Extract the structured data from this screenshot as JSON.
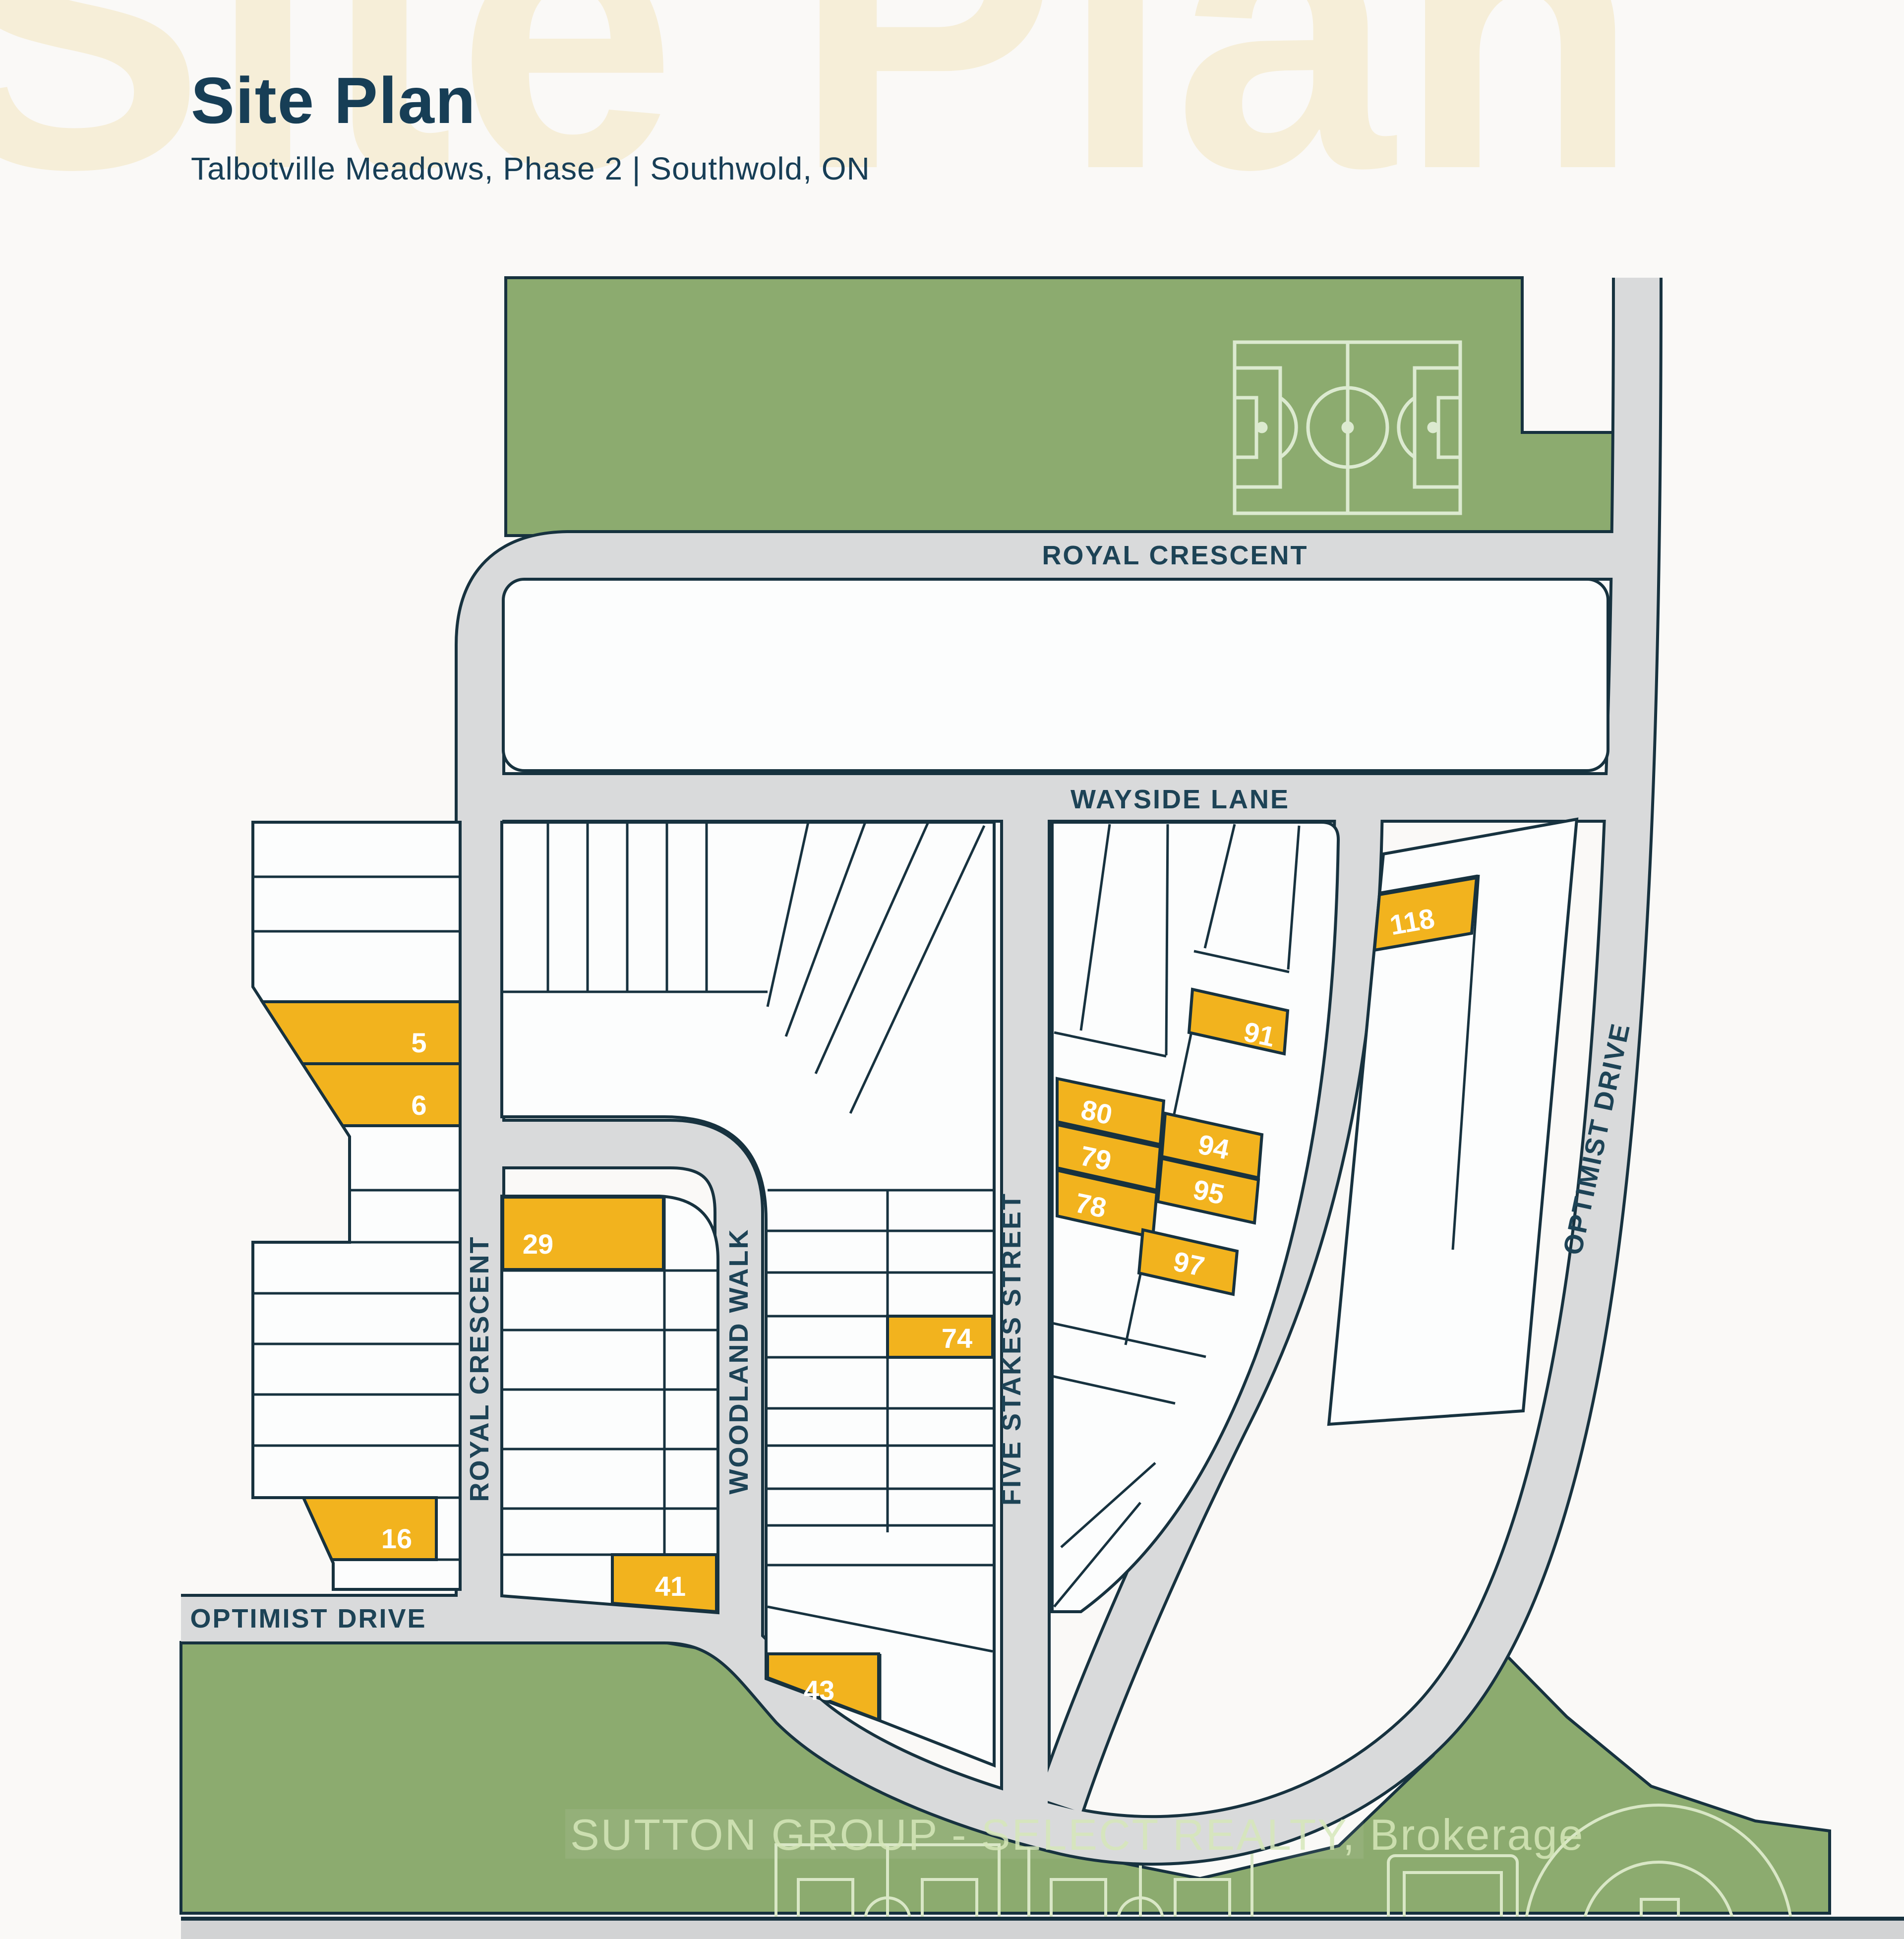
{
  "header": {
    "title": "Site Plan",
    "subtitle": "Talbotville Meadows, Phase 2  |  Southwold, ON"
  },
  "watermarks": {
    "page_background_text": "Site Plan",
    "brokerage_text": "SUTTON GROUP - SELECT REALTY, Brokerage"
  },
  "streets": {
    "royal_crescent": "ROYAL CRESCENT",
    "wayside_lane": "WAYSIDE LANE",
    "woodland_walk": "WOODLAND WALK",
    "five_stakes_street": "FIVE STAKES STREET",
    "optimist_drive": "OPTIMIST DRIVE"
  },
  "lots": [
    "5",
    "6",
    "16",
    "29",
    "41",
    "43",
    "74",
    "78",
    "79",
    "80",
    "91",
    "94",
    "95",
    "97",
    "118"
  ],
  "amenities": [
    "soccer-field",
    "sports-fields",
    "baseball-diamond",
    "court"
  ],
  "colors": {
    "highlight_lot": "#f2b31e",
    "park_green": "#8cab6f",
    "road_grey": "#d9dadb",
    "outline_navy": "#17323f",
    "street_label": "#1d4356",
    "title_navy": "#173e56",
    "watermark_cream": "#f6eed8",
    "field_line": "#d9e7c6"
  }
}
